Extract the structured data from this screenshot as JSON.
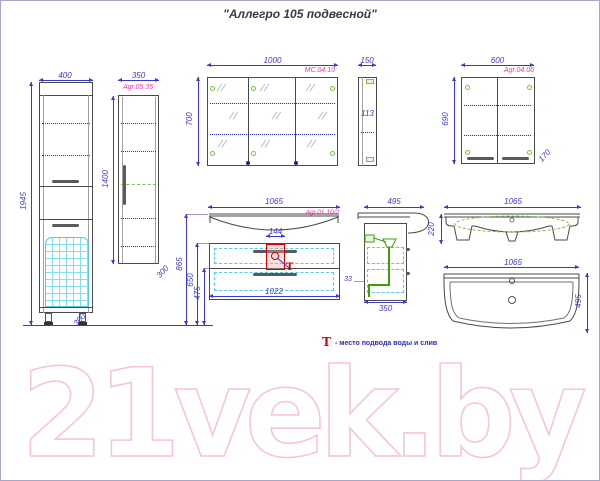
{
  "title": "\"Аллегро 105 подвесной\"",
  "watermark": "21vek.by",
  "legend": {
    "symbol": "Т",
    "text": "- место подвода воды и слив"
  },
  "colors": {
    "dimension": "#3a3ac6",
    "label_magenta": "#e43ba2",
    "accent_red": "#d40000",
    "green": "#7cc244",
    "cyan": "#55c8e6",
    "watermark_pink": "#f7c5d5"
  },
  "views": {
    "tall_cabinet_1": {
      "code": "Agr.05.04",
      "width": "400",
      "height": "1945",
      "depth": "300"
    },
    "tall_cabinet_2": {
      "code": "Agr.05.35",
      "width": "350",
      "height": "1400",
      "depth": "300"
    },
    "mirror_cabinet": {
      "code": "MC.04.10",
      "width": "1000",
      "height": "700",
      "side_width": "150",
      "side_depth": "113"
    },
    "wall_cabinet": {
      "code": "Agr.04.06",
      "width": "600",
      "height": "690",
      "depth": "170"
    },
    "vanity_front": {
      "code": "Agr.01.10/2",
      "width": "1065",
      "inner_width": "1022",
      "center_detail": "144",
      "height_to_basin": "865",
      "height_to_top": "650",
      "height_clearance": "475"
    },
    "vanity_side": {
      "depth_top": "495",
      "depth_bottom": "350",
      "drain_offset": "33"
    },
    "basin_front": {
      "width": "1065",
      "height": "220"
    },
    "basin_plan": {
      "width": "1065",
      "depth": "495"
    }
  }
}
